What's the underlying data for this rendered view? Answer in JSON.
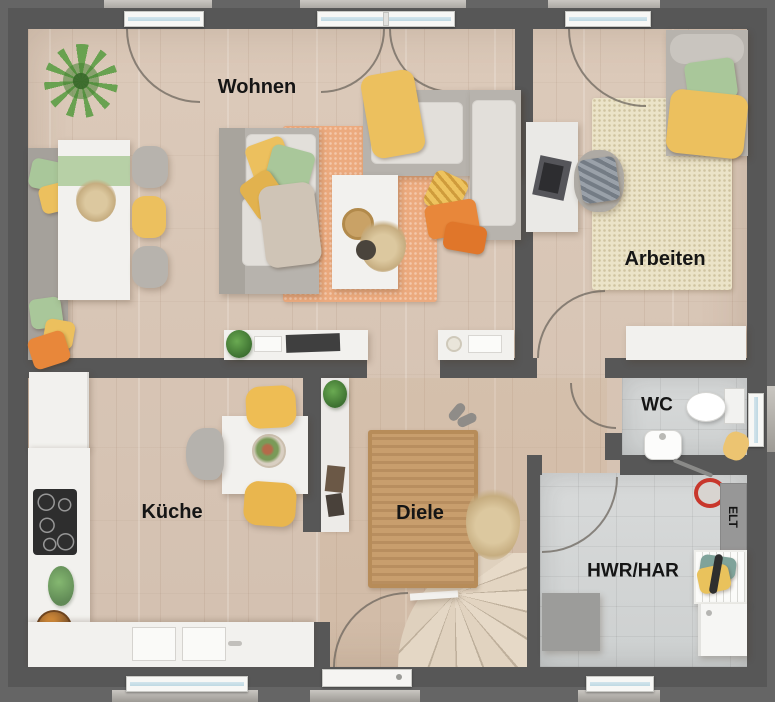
{
  "app": {
    "type": "floor-plan-rendering",
    "floor": "ground-floor"
  },
  "rooms": {
    "wohnen": {
      "label": "Wohnen"
    },
    "arbeiten": {
      "label": "Arbeiten"
    },
    "kueche": {
      "label": "Küche"
    },
    "diele": {
      "label": "Diele"
    },
    "wc": {
      "label": "WC"
    },
    "hwr_har": {
      "label": "HWR/HAR"
    },
    "elt": {
      "label": "ELT"
    }
  },
  "palette": {
    "exterior": "#656565",
    "wall": "#575757",
    "wood_floor": "#d8c6b6",
    "tile_floor": "#d4d6d6",
    "counter_white": "#f2f1ee",
    "sofa_grey": "#b7b3ad",
    "cushion_white": "#e2dfda",
    "rug_orange": "#ecaa7e",
    "rug_cream": "#ebe3c8",
    "rug_jute": "#c89e6d",
    "accent_yellow": "#ecc05e",
    "accent_green": "#a9c79a",
    "accent_orange": "#e8873a",
    "stair_wood": "#e4d7c5",
    "window_glass": "#bfd8e2",
    "bucket_red": "#c8372c",
    "label_text": "#151515"
  }
}
